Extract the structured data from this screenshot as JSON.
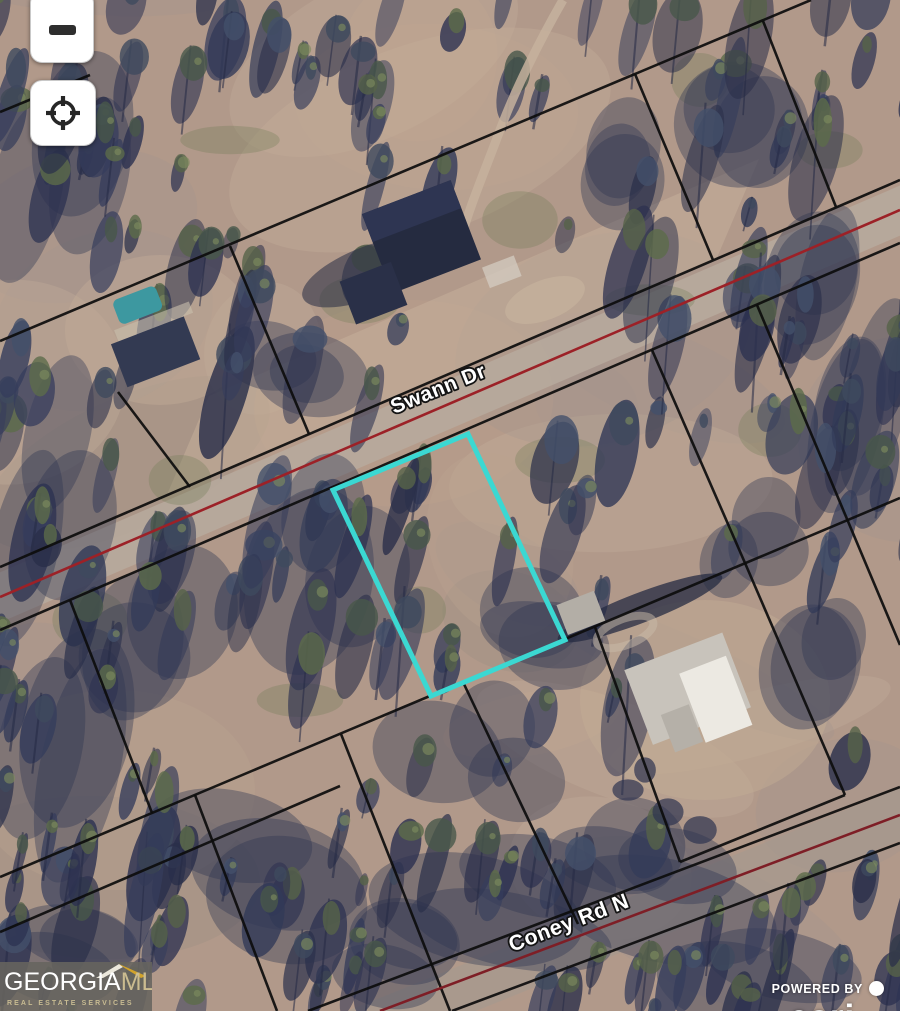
{
  "map": {
    "roads": [
      {
        "label": "Swann Dr"
      },
      {
        "label": "Coney Rd N"
      }
    ],
    "selected_parcel": {
      "outline_color": "#3BD8D2"
    },
    "parcel_line_color": "#0d0d0d",
    "road_centerline_colors": {
      "swann": "#9c2127",
      "coney": "#7e1e26"
    }
  },
  "controls": [
    {
      "name": "zoom-out",
      "icon": "minus-icon"
    },
    {
      "name": "locate",
      "icon": "crosshair-icon"
    }
  ],
  "branding": {
    "logo_primary": "GEORGIA",
    "logo_secondary": "MLS",
    "logo_tagline": "REAL ESTATE SERVICES"
  },
  "attribution": {
    "powered_by_label": "POWERED BY",
    "provider": "esri"
  }
}
